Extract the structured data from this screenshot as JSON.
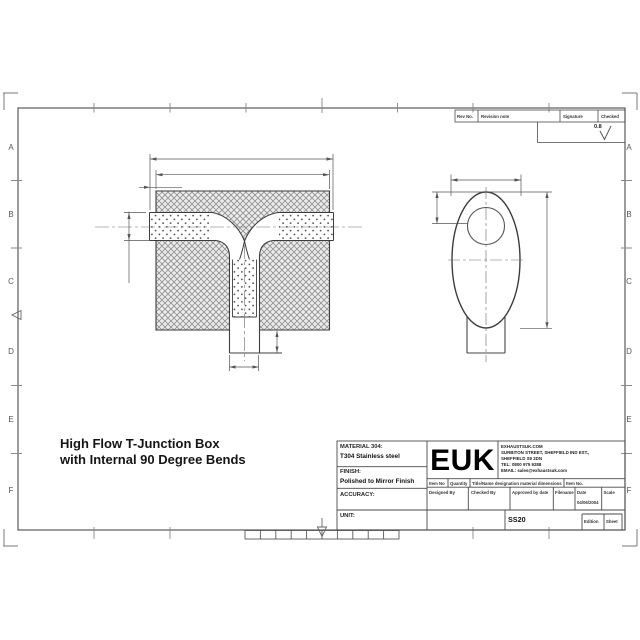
{
  "sheet": {
    "row_labels": [
      "A",
      "B",
      "C",
      "D",
      "E",
      "F"
    ],
    "surface_finish_value": "0.8"
  },
  "revision_table": {
    "headers": [
      "Rev No.",
      "Revision note",
      "Signature",
      "Checked"
    ]
  },
  "drawing_title": {
    "line1": "High Flow T-Junction Box",
    "line2": "with Internal 90 Degree Bends"
  },
  "title_block": {
    "material_label": "MATERIAL 304:",
    "material_value": "T304 Stainless steel",
    "finish_label": "FINISH:",
    "finish_value": "Polished to Mirror Finish",
    "accuracy_label": "ACCURACY:",
    "unit_label": "UNIT:",
    "logo_text": "EUK",
    "address_lines": [
      "EXHAUSTSUK.COM",
      "SURBITON STREET, SHEFFIELD IND EST.,",
      "SHEFFIELD S9 2DN",
      "TEL: 0800 975 9288",
      "EMAIL: sales@exhaustsuk.com"
    ],
    "parts_row_headers": [
      "Item No",
      "Quantity",
      "Title/Name designation material dimensions",
      "Item No."
    ],
    "approval_row_headers": [
      "Designed By",
      "Checked By",
      "Approved by date",
      "Filename",
      "Date",
      "Scale"
    ],
    "date_value": "04/06/2004",
    "drawing_number": "SS20",
    "edition_label": "Edition",
    "sheet_label": "Sheet"
  },
  "colors": {
    "ink": "#3d3d3d",
    "frame": "#5a5a5a",
    "hatch": "#8f8f8f",
    "paper": "#ffffff"
  }
}
